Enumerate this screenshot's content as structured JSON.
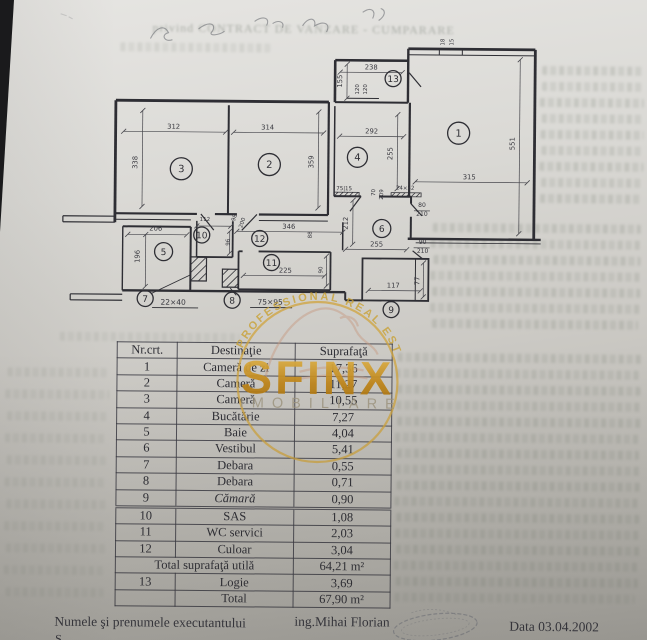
{
  "logo": {
    "name": "SFINX",
    "subtitle": "IMOBILIARE",
    "arc_text": "PROFESSIONAL REAL ESTATE",
    "gold": "#c79a2e"
  },
  "bleed_fragment": "privind CONTRACT DE VANZARE - CUMPARARE",
  "table": {
    "headers": [
      "Nr.crt.",
      "Destinaţie",
      "Suprafaţă"
    ],
    "rows": [
      {
        "nr": "1",
        "dest": "Cameră de zi",
        "sup": "17,36"
      },
      {
        "nr": "2",
        "dest": "Cameră",
        "sup": "11,27"
      },
      {
        "nr": "3",
        "dest": "Cameră",
        "sup": "10,55"
      },
      {
        "nr": "4",
        "dest": "Bucătărie",
        "sup": "7,27"
      },
      {
        "nr": "5",
        "dest": "Baie",
        "sup": "4,04"
      },
      {
        "nr": "6",
        "dest": "Vestibul",
        "sup": "5,41"
      },
      {
        "nr": "7",
        "dest": "Debara",
        "sup": "0,55"
      },
      {
        "nr": "8",
        "dest": "Debara",
        "sup": "0,71"
      },
      {
        "nr": "9",
        "dest": "Cămară",
        "sup": "0,90",
        "italic": true,
        "dbl": true
      },
      {
        "nr": "10",
        "dest": "SAS",
        "sup": "1,08"
      },
      {
        "nr": "11",
        "dest": "WC servici",
        "sup": "2,03"
      },
      {
        "nr": "12",
        "dest": "Culoar",
        "sup": "3,04"
      },
      {
        "nr": "",
        "dest": "Total suprafaţă utilă",
        "sup": "64,21 m²",
        "span": true
      },
      {
        "nr": "13",
        "dest": "Logie",
        "sup": "3,69"
      },
      {
        "nr": "",
        "dest": "Total",
        "sup": "67,90 m²"
      }
    ]
  },
  "footer": {
    "label": "Numele şi prenumele executantului",
    "executor": "ing.Mihai Florian",
    "date": "Data 03.04.2002",
    "cut_line": "S"
  },
  "plan": {
    "rooms": [
      {
        "n": "1",
        "x": 457,
        "y": 132,
        "r": 11
      },
      {
        "n": "2",
        "x": 268,
        "y": 165,
        "r": 11
      },
      {
        "n": "3",
        "x": 180,
        "y": 170,
        "r": 11
      },
      {
        "n": "4",
        "x": 356,
        "y": 157,
        "r": 10
      },
      {
        "n": "5",
        "x": 163,
        "y": 253,
        "r": 9
      },
      {
        "n": "6",
        "x": 381,
        "y": 228,
        "r": 9
      },
      {
        "n": "7",
        "x": 145,
        "y": 300,
        "r": 8
      },
      {
        "n": "8",
        "x": 232,
        "y": 301,
        "r": 8
      },
      {
        "n": "9",
        "x": 391,
        "y": 309,
        "r": 8
      },
      {
        "n": "10",
        "x": 201,
        "y": 236,
        "r": 8
      },
      {
        "n": "11",
        "x": 271,
        "y": 263,
        "r": 8
      },
      {
        "n": "12",
        "x": 259,
        "y": 239,
        "r": 8
      },
      {
        "n": "13",
        "x": 391,
        "y": 78,
        "r": 8
      }
    ],
    "dims": [
      {
        "t": "312",
        "x": 172,
        "y": 130
      },
      {
        "t": "338",
        "x": 136,
        "y": 164,
        "rot": -90
      },
      {
        "t": "314",
        "x": 266,
        "y": 130
      },
      {
        "t": "359",
        "x": 312,
        "y": 162,
        "rot": -90
      },
      {
        "t": "238",
        "x": 369,
        "y": 69
      },
      {
        "t": "155",
        "x": 340,
        "y": 81,
        "rot": -90
      },
      {
        "t": "120",
        "x": 357,
        "y": 89,
        "rot": -90,
        "fs": 5.5
      },
      {
        "t": "120",
        "x": 365,
        "y": 89,
        "rot": -90,
        "fs": 5.5
      },
      {
        "t": "292",
        "x": 370,
        "y": 133
      },
      {
        "t": "255",
        "x": 391,
        "y": 153,
        "rot": -90
      },
      {
        "t": "315",
        "x": 468,
        "y": 178
      },
      {
        "t": "551",
        "x": 513,
        "y": 142,
        "rot": -90
      },
      {
        "t": "18",
        "x": 442,
        "y": 41,
        "rot": -90,
        "fs": 5.5
      },
      {
        "t": "15",
        "x": 451,
        "y": 41,
        "rot": -90,
        "fs": 5.5
      },
      {
        "t": "206",
        "x": 155,
        "y": 232
      },
      {
        "t": "196",
        "x": 139,
        "y": 258,
        "rot": -90
      },
      {
        "t": "112",
        "x": 204,
        "y": 222,
        "fs": 5.5
      },
      {
        "t": "98",
        "x": 235,
        "y": 219,
        "rot": -72,
        "fs": 5.5
      },
      {
        "t": "200",
        "x": 243,
        "y": 224,
        "rot": -72,
        "fs": 5.5
      },
      {
        "t": "346",
        "x": 288,
        "y": 229
      },
      {
        "t": "88",
        "x": 311,
        "y": 235,
        "rot": -90,
        "fs": 5.5
      },
      {
        "t": "96",
        "x": 229,
        "y": 243,
        "rot": -90,
        "fs": 5.5
      },
      {
        "t": "225",
        "x": 285,
        "y": 273
      },
      {
        "t": "90",
        "x": 322,
        "y": 270,
        "rot": -90,
        "fs": 5.5
      },
      {
        "t": "70",
        "x": 374,
        "y": 192,
        "rot": -90,
        "fs": 5.5
      },
      {
        "t": "209",
        "x": 382,
        "y": 194,
        "rot": -90,
        "fs": 5.5
      },
      {
        "t": "24×52",
        "x": 404,
        "y": 189,
        "fs": 5.5
      },
      {
        "t": "75|15",
        "x": 343,
        "y": 190,
        "fs": 5.5
      },
      {
        "t": "80",
        "x": 421,
        "y": 206,
        "fs": 6
      },
      {
        "t": "210",
        "x": 421,
        "y": 215,
        "fs": 6
      },
      {
        "t": "90",
        "x": 422,
        "y": 243,
        "fs": 6
      },
      {
        "t": "210",
        "x": 422,
        "y": 252,
        "fs": 6
      },
      {
        "t": "255",
        "x": 376,
        "y": 246
      },
      {
        "t": "212",
        "x": 347,
        "y": 223,
        "rot": -90
      },
      {
        "t": "117",
        "x": 393,
        "y": 287
      },
      {
        "t": "77",
        "x": 419,
        "y": 280,
        "rot": -90
      },
      {
        "t": "22×40",
        "x": 173,
        "y": 306,
        "fs": 7.5
      },
      {
        "t": "75×95",
        "x": 270,
        "y": 305,
        "fs": 7.5
      }
    ]
  }
}
